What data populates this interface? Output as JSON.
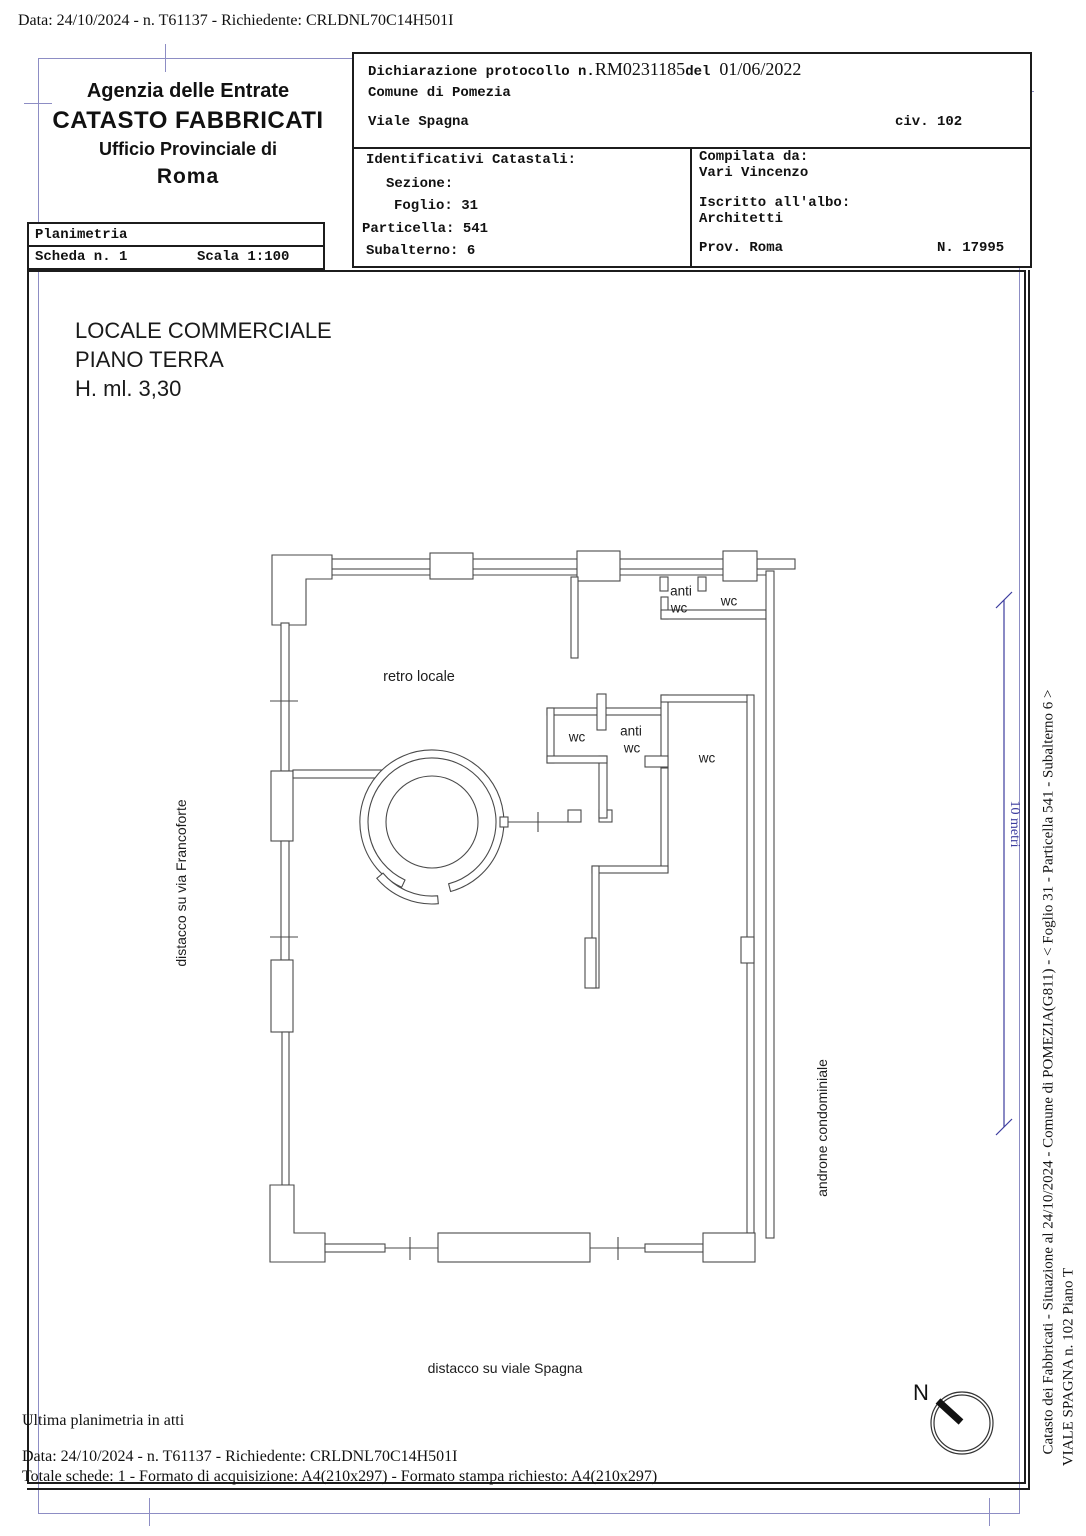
{
  "page": {
    "top_line": "Data: 24/10/2024 - n. T61137 - Richiedente: CRLDNL70C14H501I",
    "frame_blue": "#8d8dc4",
    "dimension_blue": "#3c3c9e"
  },
  "header": {
    "agency_line1": "Agenzia delle Entrate",
    "agency_line2": "CATASTO FABBRICATI",
    "agency_line3": "Ufficio Provinciale di",
    "agency_line4": "Roma",
    "planimetria": "Planimetria",
    "scheda": "Scheda n. 1",
    "scala": "Scala 1:100",
    "dich_label": "Dichiarazione protocollo n.",
    "dich_protocol": "RM0231185",
    "dich_del": "del",
    "dich_date": "01/06/2022",
    "comune": "Comune di Pomezia",
    "via": "Viale Spagna",
    "civico": "civ. 102",
    "ident_title": "Identificativi Catastali:",
    "sezione": "Sezione:",
    "foglio": "Foglio: 31",
    "particella": "Particella: 541",
    "subalterno": "Subalterno: 6",
    "compilata_da": "Compilata da:",
    "compilatore": "Vari Vincenzo",
    "iscritto": "Iscritto all'albo:",
    "albo": "Architetti",
    "prov": "Prov. Roma",
    "albo_n": "N. 17995"
  },
  "plan": {
    "title1": "LOCALE COMMERCIALE",
    "title2": "PIANO TERRA",
    "title3": "H. ml. 3,30",
    "room_retro": "retro locale",
    "anti": "anti",
    "wc": "wc",
    "label_left": "distacco su via Francoforte",
    "label_right": "androne condominiale",
    "label_bottom": "distacco su viale Spagna",
    "scale_bar": "10 metri",
    "north": "N"
  },
  "footer": {
    "line1": "Ultima planimetria in atti",
    "line2": "Data: 24/10/2024 - n. T61137 - Richiedente: CRLDNL70C14H501I",
    "line3": "Totale schede: 1 - Formato di acquisizione: A4(210x297)  - Formato stampa richiesto: A4(210x297)"
  },
  "margin": {
    "line1": "Catasto dei Fabbricati - Situazione al 24/10/2024 - Comune di POMEZIA(G811) - <  Foglio 31 - Particella  541 - Subalterno 6 >",
    "line2": "VIALE SPAGNA n. 102 Piano T"
  }
}
